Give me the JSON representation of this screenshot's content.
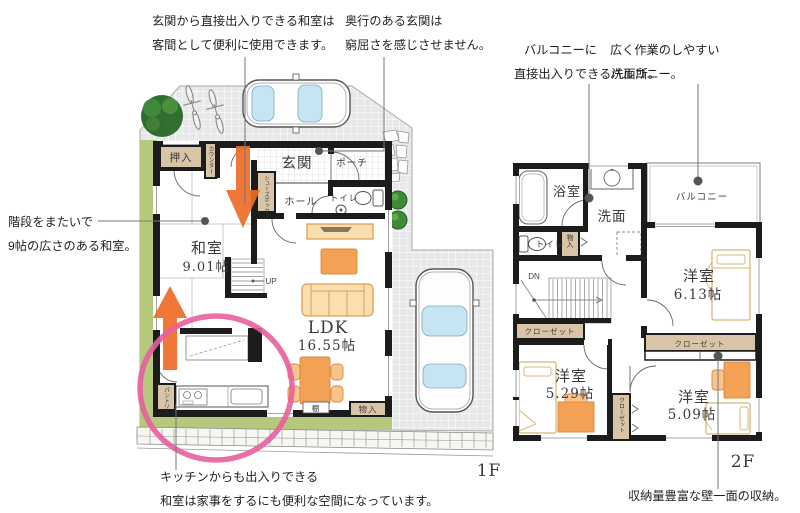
{
  "annotations": {
    "a1": {
      "line1": "玄関から直接出入りできる和室は",
      "line2": "客間として便利に使用できます。"
    },
    "a2": {
      "line1": "奥行のある玄関は",
      "line2": "窮屈さを感じさせません。"
    },
    "a3": {
      "line1": "階段をまたいで",
      "line2": "9帖の広さのある和室。"
    },
    "a4": {
      "line1": "キッチンからも出入りできる",
      "line2": "和室は家事をするにも便利な空間になっています。"
    },
    "a5": {
      "line1": "バルコニーに",
      "line2": "直接出入りできる洗面所。"
    },
    "a6": {
      "line1": "広く作業のしやすい",
      "line2": "バルコニー。"
    },
    "a7": {
      "line1": "収納量豊富な壁一面の収納。"
    }
  },
  "floor1": {
    "label": "1F",
    "oshiire": "押入",
    "counter": "カウンター",
    "genkan": "玄関",
    "porch": "ポーチ",
    "shoebox": "シューズボックス",
    "hall": "ホール",
    "toilet": "トイレ",
    "washitsu_name": "和室",
    "washitsu_size": "9.01帖",
    "up": "UP",
    "ldk_name": "LDK",
    "ldk_size": "16.55帖",
    "pantry": "パントリー",
    "shelf": "棚",
    "storage": "物入"
  },
  "floor2": {
    "label": "2F",
    "bath": "浴室",
    "washroom": "洗面",
    "balcony": "バルコニー",
    "toilet": "トイレ",
    "storage": "物入",
    "down": "DN",
    "closet_a": "クローゼット",
    "closet_b": "クローゼット",
    "closet_c": "クローゼット",
    "room1_name": "洋室",
    "room1_size": "6.13帖",
    "room2_name": "洋室",
    "room2_size": "5.29帖",
    "room3_name": "洋室",
    "room3_size": "5.09帖"
  },
  "colors": {
    "wall": "#1c1c1c",
    "tan_box": "#d8c5a8",
    "grass_green": "#b6c87b",
    "furniture_tan": "#f9deb0",
    "accent_orange": "#f2a155",
    "arrow_orange": "#ee6c28",
    "highlight_pink": "#e75f9f",
    "paving_gray": "#e6e8ea",
    "car_window_blue": "#c6e4f2"
  }
}
